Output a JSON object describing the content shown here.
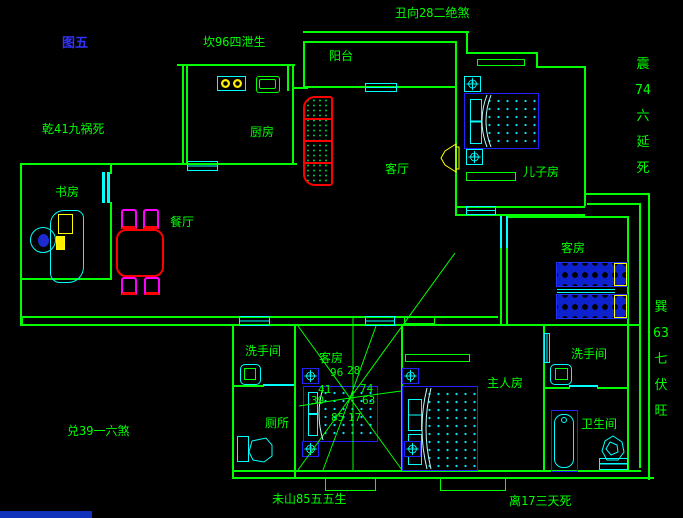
{
  "figure": {
    "label": "图五"
  },
  "annotations": {
    "kan": "坎96四泄生",
    "chou": "丑向28二绝煞",
    "qian": "乾41九祸死",
    "dui": "兑39一六煞",
    "wei": "未山85五五生",
    "li": "离17三天死",
    "zhen": "震\n74\n六\n延\n死",
    "xun": "巽\n63\n七\n伏\n旺"
  },
  "rooms": {
    "balcony": "阳台",
    "kitchen": "厨房",
    "study": "书房",
    "dining": "餐厅",
    "living": "客厅",
    "sons_room": "儿子房",
    "guest_room_right": "客房",
    "guest_room_center": "客房",
    "master": "主人房",
    "washroom_left": "洗手间",
    "toilet": "厕所",
    "washroom_right": "洗手间",
    "bathroom": "卫生间"
  },
  "compass": {
    "numbers": {
      "n96": "96",
      "n28": "28",
      "n41": "41",
      "n74": "74",
      "n39": "39",
      "n63": "63",
      "n85": "85",
      "n17": "17"
    }
  },
  "colors": {
    "wall": "#00ff00",
    "fixture": "#00ffff",
    "furniture_blue": "#2222ff",
    "accent_red": "#ff0000",
    "accent_magenta": "#ff00ff",
    "accent_yellow": "#ffff00",
    "title_blue": "#3333ff",
    "background": "#000000"
  }
}
